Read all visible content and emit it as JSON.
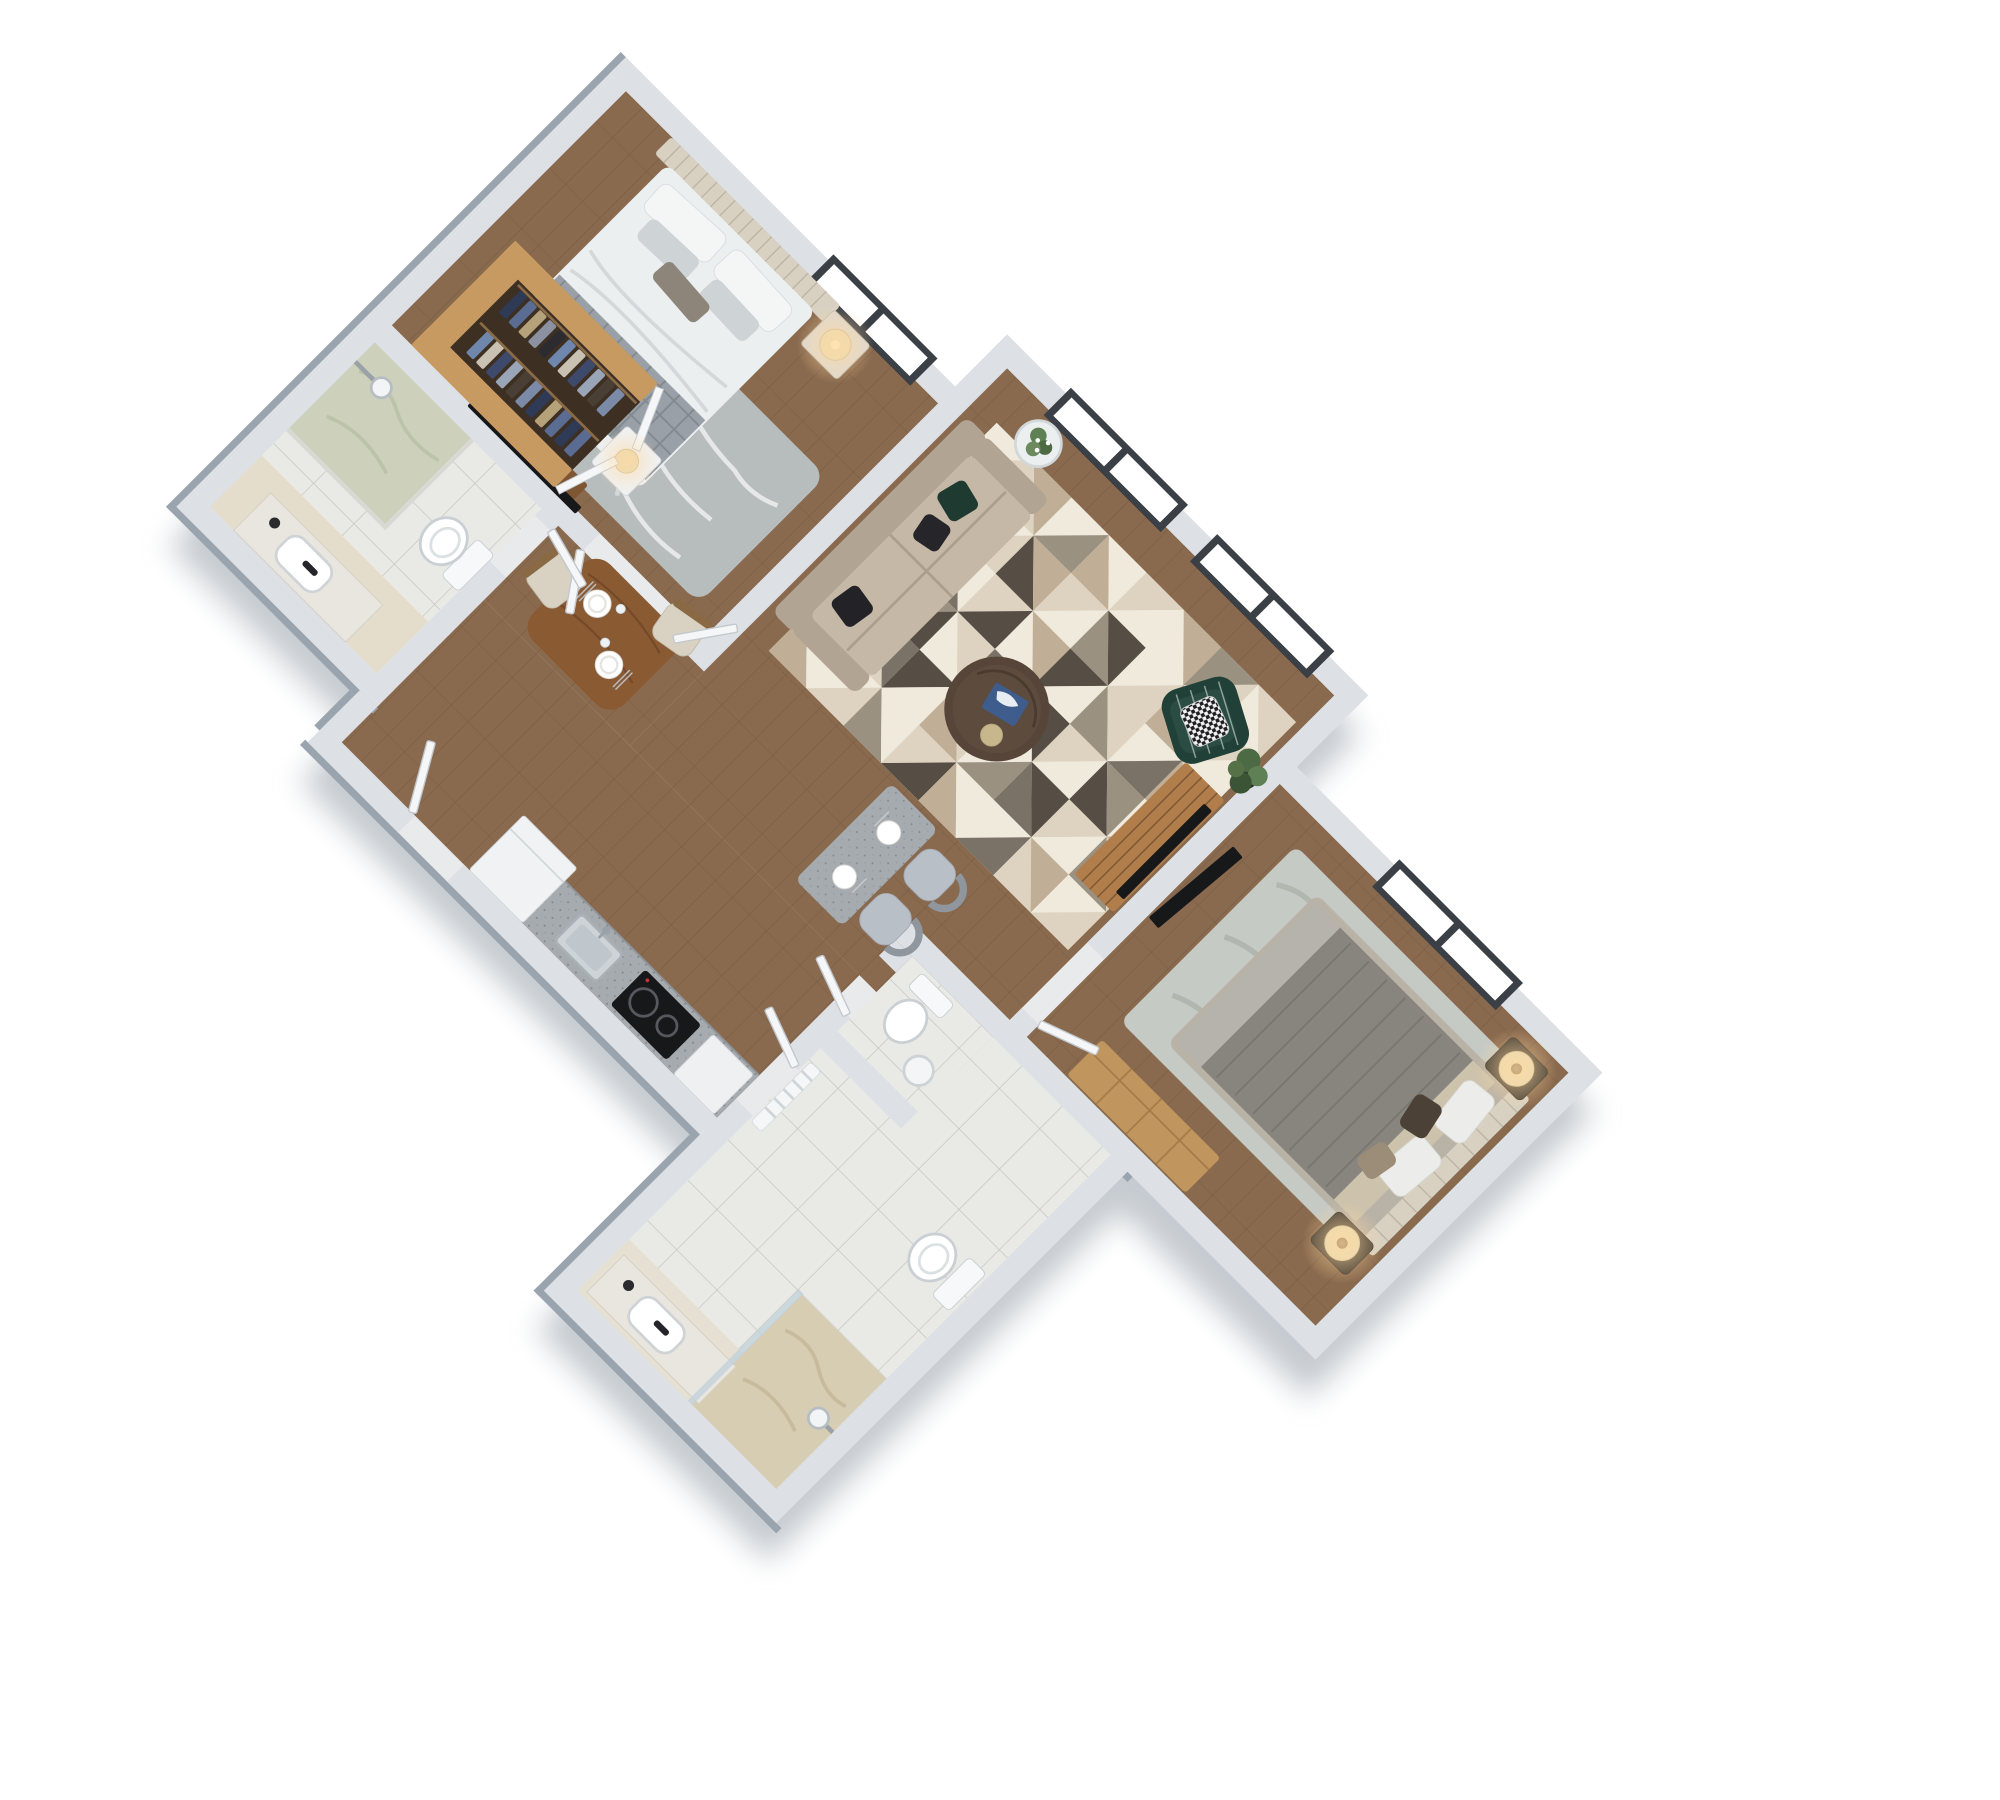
{
  "meta": {
    "title": "3D isometric floor plan render - two bedroom apartment",
    "view": "top-down axonometric, plan rotated 45 degrees, no visible text"
  },
  "palette": {
    "page_bg": "#ffffff",
    "shadow": "#8d97a2",
    "wall": "#dde1e5",
    "wall_edge": "#9aa4af",
    "wall_inner_shade": "#c7ccd2",
    "wood": "#8a6a4e",
    "wood_line": "#5f4632",
    "tile": "#e9e9e6",
    "tile_line": "#c6c6c1",
    "marble_sage": "#cdd1bc",
    "marble_beige": "#d7cdb2",
    "mat_beige": "#e4ddcc",
    "closet_wood": "#c79a62",
    "closet_floor": "#3e2f23",
    "granite": "#a6abaf",
    "fixture_white": "#f7f8f9",
    "fixture_stroke": "#c3c9cd",
    "faucet_black": "#26262a",
    "window_frame": "#3b4046",
    "glass_white": "#ffffff",
    "door_leaf": "#f5f6f7",
    "door_stroke": "#c2c8ce",
    "sofa_body": "#b2a493",
    "sofa_seat": "#c6b8a6",
    "pillow_green": "#1f3a31",
    "pillow_black": "#26262a",
    "chair_green": "#214138",
    "rug1": "#b7bcbc",
    "rug1_line": "#eef0ef",
    "rug2": "#c6cac4",
    "rug2_line": "#a9b0a7",
    "table_walnut": "#57453a",
    "dining_wood": "#8a5a33",
    "chair_cream": "#d9d2c2",
    "tv_black": "#17181a",
    "media_oak": "#b07d4b",
    "dresser_oak": "#c0955e",
    "bed1_duvet": "#eceff0",
    "bed1_throw": "#99a0a7",
    "headboard": "#d8d1c2",
    "bed2_duvet": "#87857e",
    "bed2_foot": "#b5b3ac",
    "bed2_band": "#cdc3ac",
    "lamp_shade": "#e9dab6",
    "glow": "#ffd9a0",
    "plant_dark": "#3c5436",
    "plant_mid": "#4c6a43",
    "plant_light": "#5f7f54",
    "book_blue": "#3e5c8c",
    "gold": "#c8b78c",
    "fridge_white": "#f0f2f4",
    "cabinet_white": "#eef0f2"
  },
  "rooms": [
    {
      "id": "master-bedroom",
      "name": "Master Bedroom",
      "floor": "wood"
    },
    {
      "id": "walk-in-closet",
      "name": "Walk-in Closet",
      "floor": "dark wood"
    },
    {
      "id": "bathroom-1",
      "name": "Master Bathroom",
      "floor": "tile + sage marble shower"
    },
    {
      "id": "living-room",
      "name": "Living Room",
      "floor": "wood"
    },
    {
      "id": "dining-hall",
      "name": "Dining / Hall",
      "floor": "wood"
    },
    {
      "id": "kitchen",
      "name": "Kitchen",
      "floor": "wood"
    },
    {
      "id": "wc",
      "name": "WC",
      "floor": "tile"
    },
    {
      "id": "bathroom-2",
      "name": "Second Bathroom",
      "floor": "tile + beige marble shower"
    },
    {
      "id": "bedroom-2",
      "name": "Second Bedroom",
      "floor": "wood"
    }
  ],
  "furniture": {
    "master_bedroom": [
      "upholstered bed",
      "channel-tufted headboard",
      "nightstand with drum lamp",
      "white chest with lamp",
      "botanical rug",
      "wall TV with wood console",
      "walk-in closet with hanging clothes",
      "white closet doors"
    ],
    "living_room": [
      "beige three-seat sofa",
      "green and black velvet cushions",
      "round walnut coffee table",
      "blue art book",
      "gold tray",
      "green striped accent armchair",
      "houndstooth pillow",
      "white side table with flowers",
      "geometric triangle rug",
      "corner plant"
    ],
    "dining": [
      "walnut dining table",
      "two cream chairs",
      "two place settings with glasses"
    ],
    "bar": [
      "terrazzo high table",
      "two upholstered grey stools",
      "two place settings"
    ],
    "kitchen": [
      "white fridge",
      "granite counter",
      "inset sink with faucet",
      "black two-burner cooktop",
      "white cabinet"
    ],
    "bathroom_1": [
      "walk-in shower with sage marble floor",
      "wall shower head",
      "vanity with vessel sink and black faucet",
      "toilet"
    ],
    "wc": [
      "toilet",
      "white cylinder stool"
    ],
    "bathroom_2": [
      "toilet",
      "vanity with vessel sink and black faucet",
      "beige marble shower with glass panel",
      "shower head",
      "white radiator"
    ],
    "bedroom_2": [
      "double bed with grey duvet",
      "two dark nightstands",
      "two drum lamps",
      "damask rug",
      "oak dresser",
      "leaning TV",
      "oak media console with TV"
    ]
  },
  "living_rug": {
    "x": 540,
    "y": 110,
    "cols": 8,
    "rows": 6,
    "cell_w": 57.5,
    "cell_h": 58.4,
    "palette": [
      "#f0eadd",
      "#ddd3c0",
      "#c0af96",
      "#9a9181",
      "#7b7267",
      "#564e44",
      "#b3a794"
    ],
    "cells": [
      [
        0,
        1
      ],
      [
        1,
        2
      ],
      [
        0,
        3
      ],
      [
        2,
        0
      ],
      [
        1,
        0
      ],
      [
        0,
        2
      ],
      [
        3,
        1
      ],
      [
        0,
        1
      ],
      [
        2,
        4
      ],
      [
        0,
        1
      ],
      [
        5,
        2
      ],
      [
        1,
        0
      ],
      [
        3,
        5
      ],
      [
        0,
        1
      ],
      [
        2,
        3
      ],
      [
        1,
        0
      ],
      [
        0,
        3
      ],
      [
        4,
        0
      ],
      [
        1,
        5
      ],
      [
        0,
        2
      ],
      [
        5,
        0
      ],
      [
        3,
        1
      ],
      [
        0,
        4
      ],
      [
        2,
        1
      ],
      [
        1,
        0
      ],
      [
        3,
        5
      ],
      [
        0,
        1
      ],
      [
        4,
        2
      ],
      [
        0,
        5
      ],
      [
        1,
        0
      ],
      [
        5,
        3
      ],
      [
        0,
        2
      ],
      [
        0,
        2
      ],
      [
        1,
        4
      ],
      [
        5,
        0
      ],
      [
        2,
        1
      ],
      [
        0,
        3
      ],
      [
        4,
        5
      ],
      [
        1,
        0
      ],
      [
        3,
        1
      ],
      [
        2,
        0
      ],
      [
        0,
        1
      ],
      [
        3,
        0
      ],
      [
        1,
        5
      ],
      [
        2,
        0
      ],
      [
        0,
        4
      ],
      [
        1,
        2
      ],
      [
        0,
        1
      ]
    ]
  },
  "closet_clothes": {
    "colors": [
      "#2f3a57",
      "#5a6c91",
      "#b5a27b",
      "#8b91a0",
      "#2c2c30",
      "#6f86ad",
      "#c9c2b2",
      "#3e4a6b",
      "#9aa5b8",
      "#4a3f35",
      "#7b8aa6",
      "#2f3a57",
      "#b5a27b",
      "#5a6c91"
    ],
    "row1": {
      "x": 72,
      "y": 374,
      "step": 15,
      "count": 11,
      "w": 11,
      "h": 34
    },
    "row2": {
      "x": 78,
      "y": 430,
      "step": 15,
      "count": 11,
      "w": 11,
      "h": 34
    }
  }
}
